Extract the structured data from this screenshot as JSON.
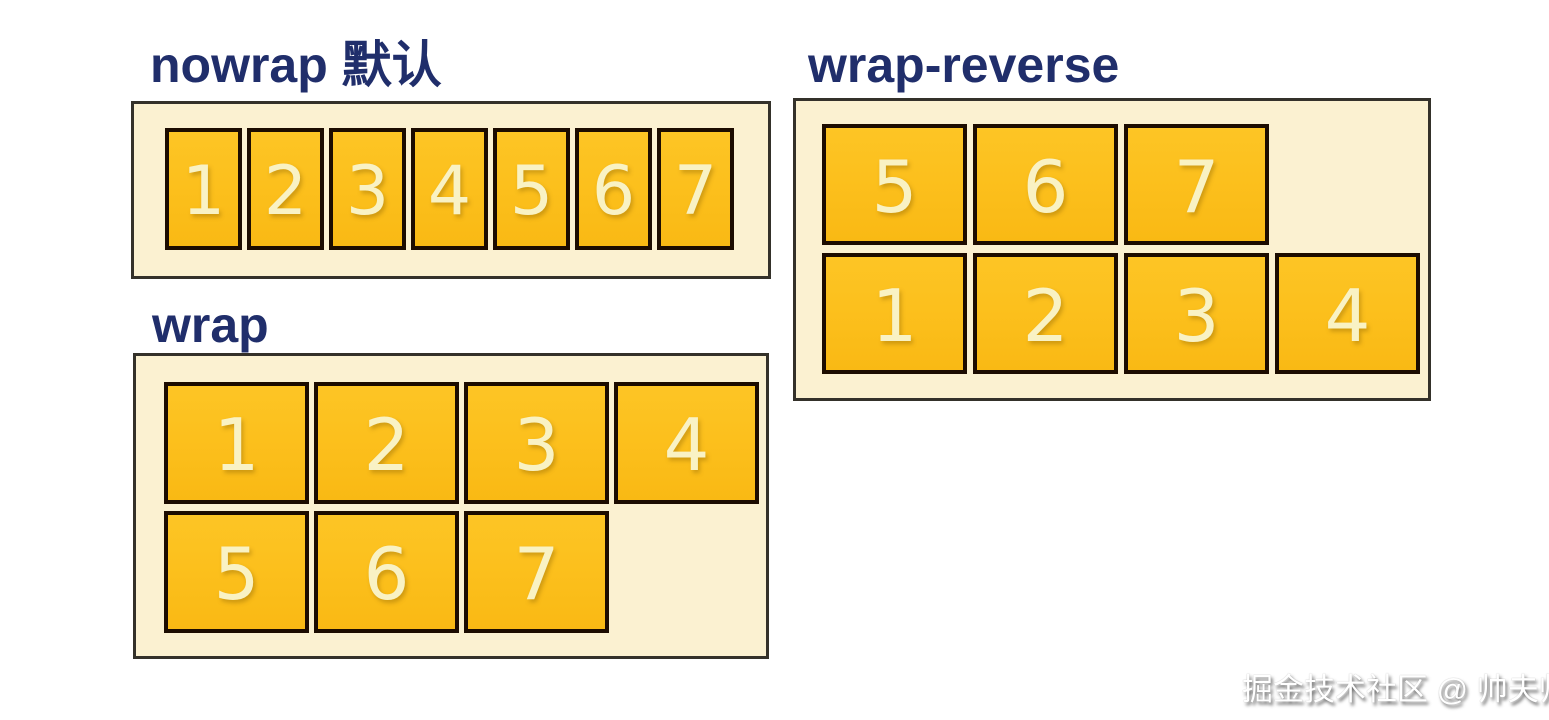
{
  "page": {
    "background": "#ffffff",
    "description": "flex-wrap property illustration"
  },
  "sections": [
    {
      "name": "nowrap",
      "title": "nowrap 默认",
      "rows": [
        [
          "1",
          "2",
          "3",
          "4",
          "5",
          "6",
          "7"
        ]
      ]
    },
    {
      "name": "wrap",
      "title": "wrap",
      "rows": [
        [
          "1",
          "2",
          "3",
          "4"
        ],
        [
          "5",
          "6",
          "7"
        ]
      ]
    },
    {
      "name": "wrap-reverse",
      "title": "wrap-reverse",
      "rows": [
        [
          "5",
          "6",
          "7"
        ],
        [
          "1",
          "2",
          "3",
          "4"
        ]
      ]
    }
  ],
  "colors": {
    "title": "#202e6b",
    "container_background": "#fbf1d1",
    "container_border": "#34312a",
    "item_background": "#fcc01d",
    "item_border": "#1c0c00",
    "item_number": "#f9f2c4",
    "watermark": "#ffffff"
  },
  "watermark": {
    "text": "掘金技术社区 @ 帅夫帅夫"
  }
}
